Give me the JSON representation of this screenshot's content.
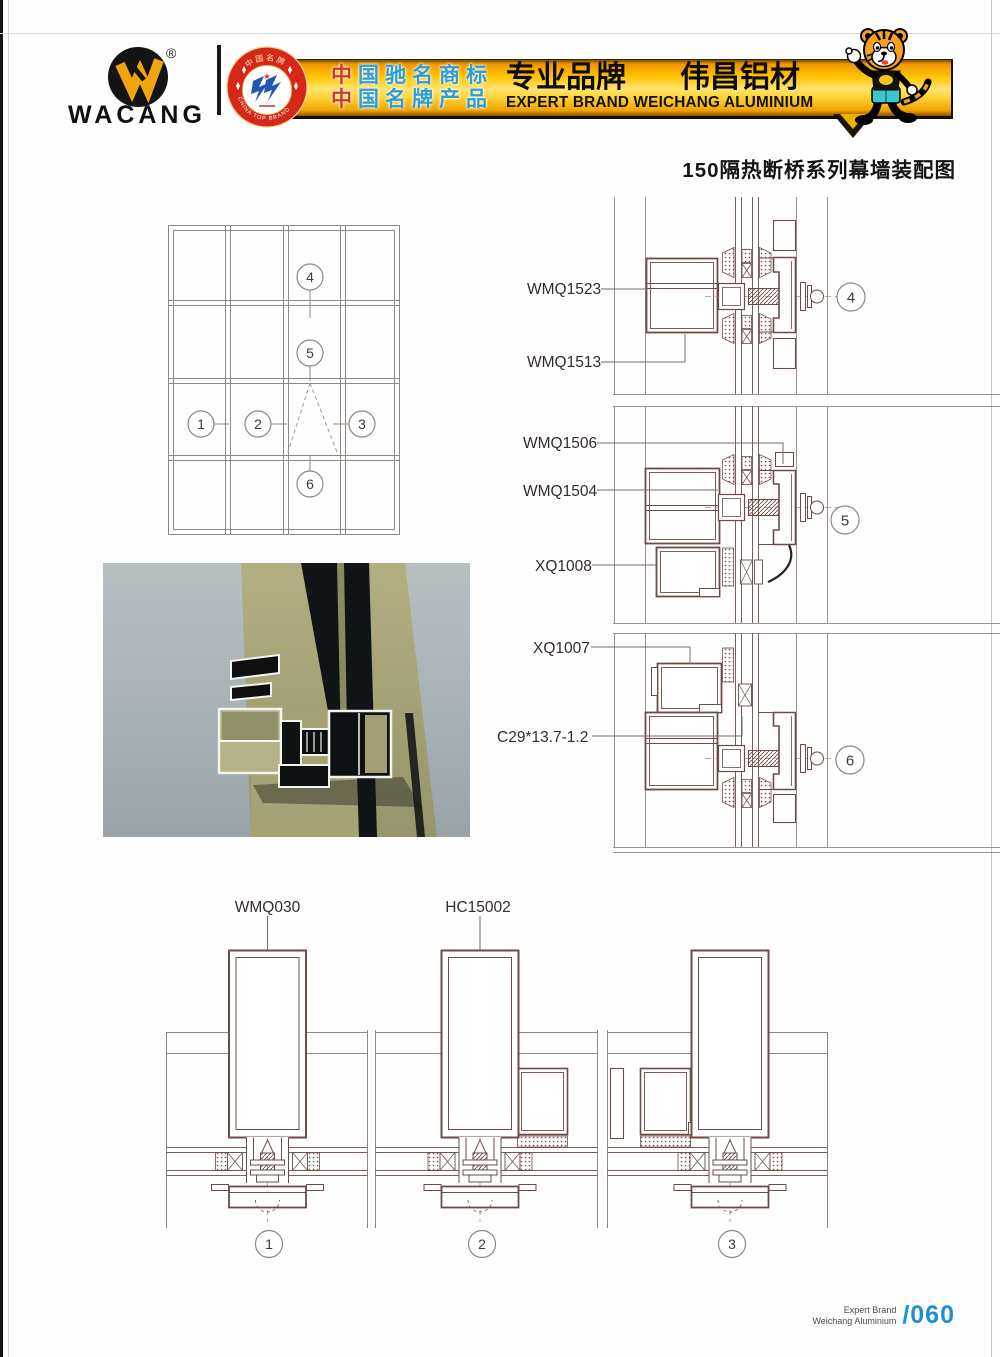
{
  "page": {
    "title": "150隔热断桥系列幕墙装配图"
  },
  "header": {
    "logo": {
      "brand": "WACANG",
      "registered": "®"
    },
    "badge": {
      "top_text": "中国名牌",
      "bottom_text": "CHINA TOP BRAND"
    },
    "honor": {
      "line1_first": "中",
      "line1_rest": "国驰名商标",
      "line2_first": "中",
      "line2_rest": "国名牌产品"
    },
    "slogan": {
      "cn_left": "专业品牌",
      "cn_right": "伟昌铝材",
      "en": "EXPERT BRAND WEICHANG ALUMINIUM"
    }
  },
  "elevation": {
    "callouts": [
      "1",
      "2",
      "3",
      "4",
      "5",
      "6"
    ]
  },
  "details": {
    "d4": {
      "num": "4",
      "labels": [
        "WMQ1523",
        "WMQ1513"
      ]
    },
    "d5": {
      "num": "5",
      "labels": [
        "WMQ1506",
        "WMQ1504",
        "XQ1008"
      ]
    },
    "d6": {
      "num": "6",
      "labels": [
        "XQ1007",
        "C29*13.7-1.2"
      ]
    }
  },
  "bottom": {
    "s1": {
      "num": "1",
      "label": "WMQ030"
    },
    "s2": {
      "num": "2",
      "label": "HC15002"
    },
    "s3": {
      "num": "3"
    }
  },
  "footer": {
    "line1": "Expert Brand",
    "line2": "Weichang Aluminium",
    "page": "/060"
  },
  "colors": {
    "banner_orange": "#f5a300",
    "banner_yellow": "#ffe373",
    "badge_red": "#d6281a",
    "honor_red": "#d0391f",
    "honor_blue": "#2e9fd4",
    "page_number_blue": "#1e8fd5",
    "drawing_maroon": "#6e4b47",
    "line_gray": "#8f8781",
    "photo_khaki": "#a8a577",
    "photo_bg": "#a9b3b8"
  }
}
